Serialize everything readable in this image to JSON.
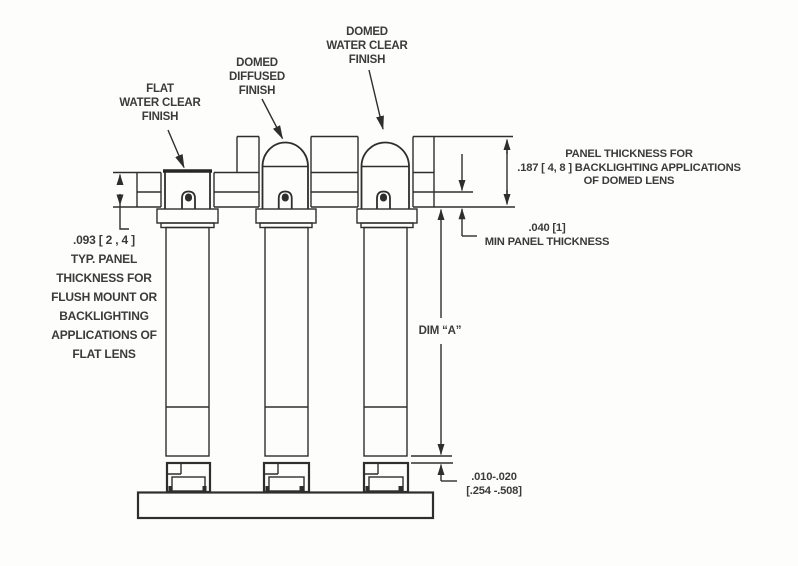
{
  "drawing": {
    "callouts": {
      "flat_lens": [
        "FLAT",
        "WATER CLEAR",
        "FINISH"
      ],
      "domed_diffused": [
        "DOMED",
        "DIFFUSED",
        "FINISH"
      ],
      "domed_water_clear": [
        "DOMED",
        "WATER CLEAR",
        "FINISH"
      ]
    },
    "dimensions": {
      "flat_panel_thickness": [
        ".093 [ 2 , 4 ]",
        "TYP. PANEL",
        "THICKNESS FOR",
        "FLUSH MOUNT OR",
        "BACKLIGHTING",
        "APPLICATIONS OF",
        "FLAT LENS"
      ],
      "domed_panel_thickness": [
        "PANEL THICKNESS FOR",
        ".187 [ 4, 8 ] BACKLIGHTING APPLICATIONS",
        "OF DOMED LENS"
      ],
      "min_panel_thickness": [
        ".040 [1]",
        "MIN PANEL THICKNESS"
      ],
      "dim_a": "DIM “A”",
      "standoff_gap": [
        ".010-.020",
        "[.254 -.508]"
      ]
    },
    "colors": {
      "line": "#2e2e2e",
      "text": "#3b3b3b",
      "background": "#fdfdfc"
    }
  }
}
